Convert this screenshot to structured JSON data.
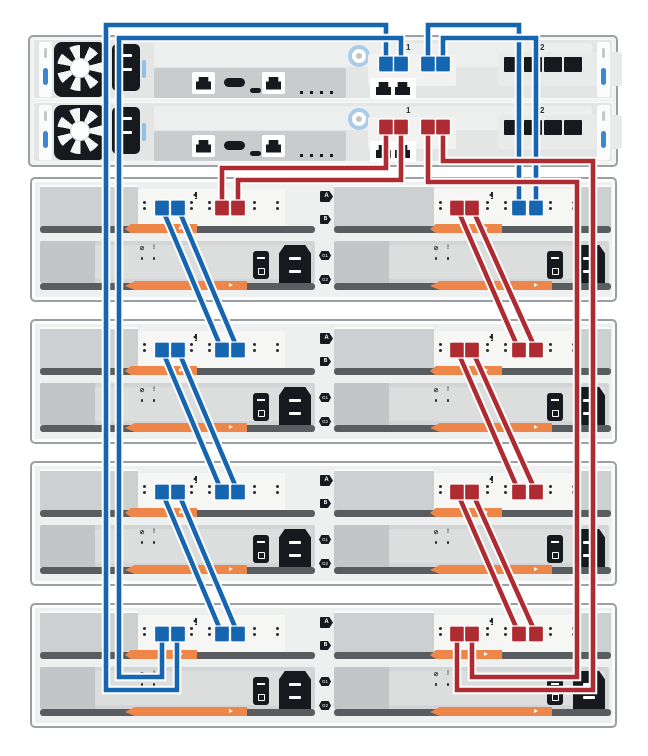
{
  "colors": {
    "blue": "#1565b0",
    "red": "#ae2b31",
    "orange": "#ef8649",
    "dark": "#16191d",
    "border": "#9aa0a4",
    "latch_blue": "#3f87cc",
    "ring_blue": "#a9cde9"
  },
  "controller_shelf": {
    "controllers": [
      {
        "id": "A",
        "sas_group_label": "1",
        "hic_group_label": "2",
        "cable": "blue"
      },
      {
        "id": "B",
        "sas_group_label": "1",
        "hic_group_label": "2",
        "cable": "red"
      }
    ]
  },
  "drive_shelves": [
    {
      "top": 177,
      "iom_a": "A",
      "iom_b": "B",
      "psu_1": "G1",
      "psu_2": "G2"
    },
    {
      "top": 319,
      "iom_a": "A",
      "iom_b": "B",
      "psu_1": "G1",
      "psu_2": "G2"
    },
    {
      "top": 461,
      "iom_a": "A",
      "iom_b": "B",
      "psu_1": "G1",
      "psu_2": "G2"
    },
    {
      "top": 603,
      "iom_a": "A",
      "iom_b": "B",
      "psu_1": "G1",
      "psu_2": "G2"
    }
  ],
  "cables": [
    {
      "id": "ctrlA-p1_shelf4-left-p2",
      "color": "b",
      "points": [
        [
          386,
          64
        ],
        [
          386,
          25
        ],
        [
          106,
          25
        ],
        [
          106,
          690
        ],
        [
          177,
          690
        ],
        [
          177,
          634
        ]
      ]
    },
    {
      "id": "ctrlA-p2_shelf4-left-p1",
      "color": "b",
      "points": [
        [
          401,
          64
        ],
        [
          401,
          38
        ],
        [
          119,
          38
        ],
        [
          119,
          677
        ],
        [
          162,
          677
        ],
        [
          162,
          634
        ]
      ]
    },
    {
      "id": "ctrlA-p3_shelf1-right-p3",
      "color": "b",
      "points": [
        [
          428,
          64
        ],
        [
          428,
          25
        ],
        [
          519,
          25
        ],
        [
          519,
          208
        ]
      ]
    },
    {
      "id": "ctrlA-p4_shelf1-right-p4",
      "color": "b",
      "points": [
        [
          443,
          64
        ],
        [
          443,
          38
        ],
        [
          536,
          38
        ],
        [
          536,
          208
        ]
      ]
    },
    {
      "id": "shelf1-left-p1_shelf2-left-p3",
      "color": "b",
      "points": [
        [
          162,
          208
        ],
        [
          222,
          350
        ]
      ]
    },
    {
      "id": "shelf1-left-p2_shelf2-left-p4",
      "color": "b",
      "points": [
        [
          178,
          208
        ],
        [
          238,
          350
        ]
      ]
    },
    {
      "id": "shelf2-left-p1_shelf3-left-p3",
      "color": "b",
      "points": [
        [
          162,
          350
        ],
        [
          222,
          492
        ]
      ]
    },
    {
      "id": "shelf2-left-p2_shelf3-left-p4",
      "color": "b",
      "points": [
        [
          178,
          350
        ],
        [
          238,
          492
        ]
      ]
    },
    {
      "id": "shelf3-left-p1_shelf4-left-p3",
      "color": "b",
      "points": [
        [
          162,
          492
        ],
        [
          222,
          634
        ]
      ]
    },
    {
      "id": "shelf3-left-p2_shelf4-left-p4",
      "color": "b",
      "points": [
        [
          178,
          492
        ],
        [
          238,
          634
        ]
      ]
    },
    {
      "id": "ctrlB-p1_shelf1-left-p3",
      "color": "r",
      "points": [
        [
          386,
          127
        ],
        [
          386,
          168
        ],
        [
          222,
          168
        ],
        [
          222,
          208
        ]
      ]
    },
    {
      "id": "ctrlB-p2_shelf1-left-p4",
      "color": "r",
      "points": [
        [
          401,
          127
        ],
        [
          401,
          180
        ],
        [
          238,
          180
        ],
        [
          238,
          208
        ]
      ]
    },
    {
      "id": "ctrlB-p3_shelf4-right-p2",
      "color": "r",
      "points": [
        [
          428,
          127
        ],
        [
          428,
          182
        ],
        [
          577,
          182
        ],
        [
          577,
          677
        ],
        [
          472,
          677
        ],
        [
          472,
          634
        ]
      ]
    },
    {
      "id": "ctrlB-p4_shelf4-right-p1",
      "color": "r",
      "points": [
        [
          443,
          127
        ],
        [
          443,
          161
        ],
        [
          593,
          161
        ],
        [
          593,
          690
        ],
        [
          457,
          690
        ],
        [
          457,
          634
        ]
      ]
    },
    {
      "id": "shelf1-right-p1_shelf2-right-p3",
      "color": "r",
      "points": [
        [
          457,
          208
        ],
        [
          519,
          350
        ]
      ]
    },
    {
      "id": "shelf1-right-p2_shelf2-right-p4",
      "color": "r",
      "points": [
        [
          472,
          208
        ],
        [
          536,
          350
        ]
      ]
    },
    {
      "id": "shelf2-right-p1_shelf3-right-p3",
      "color": "r",
      "points": [
        [
          457,
          350
        ],
        [
          519,
          492
        ]
      ]
    },
    {
      "id": "shelf2-right-p2_shelf3-right-p4",
      "color": "r",
      "points": [
        [
          472,
          350
        ],
        [
          536,
          492
        ]
      ]
    },
    {
      "id": "shelf3-right-p1_shelf4-right-p3",
      "color": "r",
      "points": [
        [
          457,
          492
        ],
        [
          519,
          634
        ]
      ]
    },
    {
      "id": "shelf3-right-p2_shelf4-right-p4",
      "color": "r",
      "points": [
        [
          472,
          492
        ],
        [
          536,
          634
        ]
      ]
    }
  ],
  "connectors": [
    [
      386,
      64,
      "b"
    ],
    [
      401,
      64,
      "b"
    ],
    [
      428,
      64,
      "b"
    ],
    [
      443,
      64,
      "b"
    ],
    [
      386,
      127,
      "r"
    ],
    [
      401,
      127,
      "r"
    ],
    [
      428,
      127,
      "r"
    ],
    [
      443,
      127,
      "r"
    ],
    [
      162,
      208,
      "b"
    ],
    [
      178,
      208,
      "b"
    ],
    [
      222,
      208,
      "r"
    ],
    [
      238,
      208,
      "r"
    ],
    [
      457,
      208,
      "r"
    ],
    [
      472,
      208,
      "r"
    ],
    [
      519,
      208,
      "b"
    ],
    [
      536,
      208,
      "b"
    ],
    [
      162,
      350,
      "b"
    ],
    [
      178,
      350,
      "b"
    ],
    [
      222,
      350,
      "b"
    ],
    [
      238,
      350,
      "b"
    ],
    [
      457,
      350,
      "r"
    ],
    [
      472,
      350,
      "r"
    ],
    [
      519,
      350,
      "r"
    ],
    [
      536,
      350,
      "r"
    ],
    [
      162,
      492,
      "b"
    ],
    [
      178,
      492,
      "b"
    ],
    [
      222,
      492,
      "b"
    ],
    [
      238,
      492,
      "b"
    ],
    [
      457,
      492,
      "r"
    ],
    [
      472,
      492,
      "r"
    ],
    [
      519,
      492,
      "r"
    ],
    [
      536,
      492,
      "r"
    ],
    [
      162,
      634,
      "b"
    ],
    [
      178,
      634,
      "b"
    ],
    [
      222,
      634,
      "b"
    ],
    [
      238,
      634,
      "b"
    ],
    [
      457,
      634,
      "r"
    ],
    [
      472,
      634,
      "r"
    ],
    [
      519,
      634,
      "r"
    ],
    [
      536,
      634,
      "r"
    ]
  ]
}
